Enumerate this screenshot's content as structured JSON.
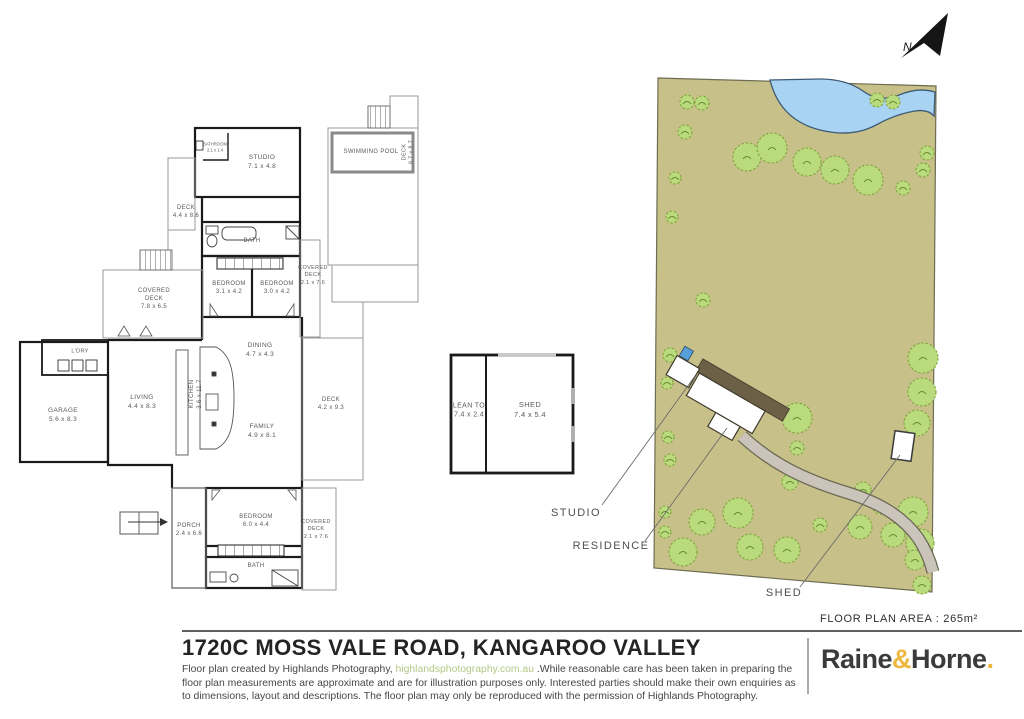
{
  "page": {
    "title": "1720C MOSS VALE ROAD, KANGAROO VALLEY",
    "floor_area_label": "FLOOR PLAN AREA  :  265m²"
  },
  "north": {
    "label": "N"
  },
  "floor_plan": {
    "studio": "STUDIO\n7.1 x 4.8",
    "studio_bath": "BATHROOM\n2.1 x 1.4",
    "deck_studio": "DECK\n4.4 x 8.6",
    "swimming_pool": "SWIMMING POOL",
    "deck_pool": "DECK\n8.7 x 8.7",
    "bath_top": "BATH",
    "bedroom_1": "BEDROOM\n3.1 x 4.2",
    "bedroom_2": "BEDROOM\n3.0 x 4.2",
    "covered_deck_right": "COVERED\nDECK\n2.1 x 7.6",
    "covered_deck_left": "COVERED\nDECK\n7.8 x 6.5",
    "ldry": "L'DRY",
    "garage": "GARAGE\n5.6 x 8.3",
    "living": "LIVING\n4.4 x 8.3",
    "kitchen": "KITCHEN\n3.6 x 11.7",
    "dining": "DINING\n4.7 x 4.3",
    "family": "FAMILY\n4.9 x 8.1",
    "deck_right": "DECK\n4.2 x 9.3",
    "porch": "PORCH\n2.4 x 6.6",
    "bedroom_3": "BEDROOM\n6.0 x 4.4",
    "bath_bottom": "BATH",
    "covered_deck_bottom": "COVERED\nDECK\n2.1 x 7.6"
  },
  "shed_plan": {
    "lean_to": "LEAN TO\n7.4 x 2.4",
    "shed": "SHED\n7.4 x 5.4"
  },
  "site_plan": {
    "studio_label": "STUDIO",
    "residence_label": "RESIDENCE",
    "shed_label": "SHED"
  },
  "footer": {
    "credit_prefix": "Floor plan created by Highlands Photography, ",
    "credit_link": "highlandsphotography.com.au",
    "credit_suffix": " .While reasonable care has been taken in preparing the floor plan measurements are approximate and are for illustration purposes only. Interested parties should make their own enquiries as to dimensions, layout and descriptions. The floor plan may only be reproduced with the permission of Highlands Photography.",
    "brand_raine": "Raine",
    "brand_amp": "&",
    "brand_horne": "Horne",
    "brand_dot": "."
  },
  "colors": {
    "land": "#c7c189",
    "tree": "#badb7d",
    "pond": "#a9d3f2",
    "driveway": "#cbc4ba",
    "deck_brown": "#6c6047",
    "accent_gold": "#ecb73f",
    "link_green": "#b4c887"
  }
}
